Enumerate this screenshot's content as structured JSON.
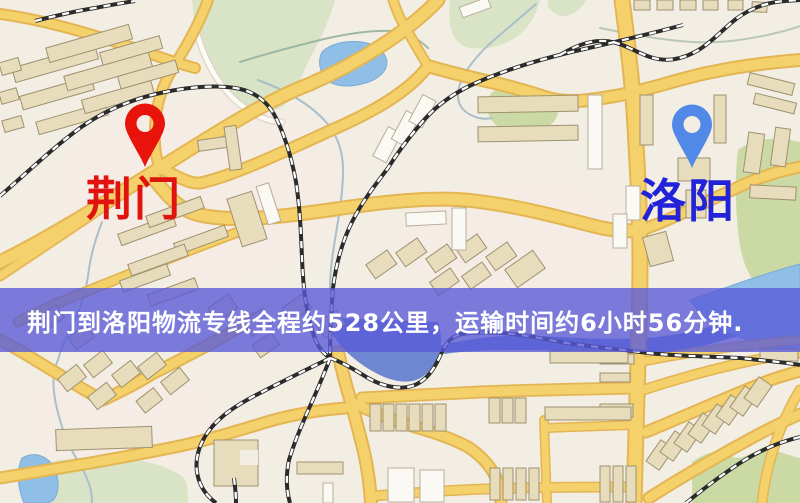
{
  "page": {
    "width": 800,
    "height": 503,
    "kind": "logistics-route-map"
  },
  "map": {
    "markers": {
      "origin": {
        "label": "荆门",
        "pin_color": "#e8140c",
        "label_color": "#e0130f"
      },
      "destination": {
        "label": "洛阳",
        "pin_color": "#5289e8",
        "label_color": "#2222d8"
      }
    },
    "banner": {
      "text": "荆门到洛阳物流专线全程约528公里，运输时间约6小时56分钟.",
      "background_color": "#585ad8",
      "text_color": "#ffffff",
      "route": {
        "origin": "荆门",
        "destination": "洛阳",
        "distance_text": "约528公里",
        "duration_text": "约6小时56分钟"
      }
    },
    "theme": {
      "land": "#f3eee4",
      "road_fill": "#f5d16b",
      "road_casing": "#e3b553",
      "park": "#d9e3c6",
      "water": "#8fbee6",
      "railway": "#2b2b2b",
      "building": "#e7dcbb"
    }
  }
}
